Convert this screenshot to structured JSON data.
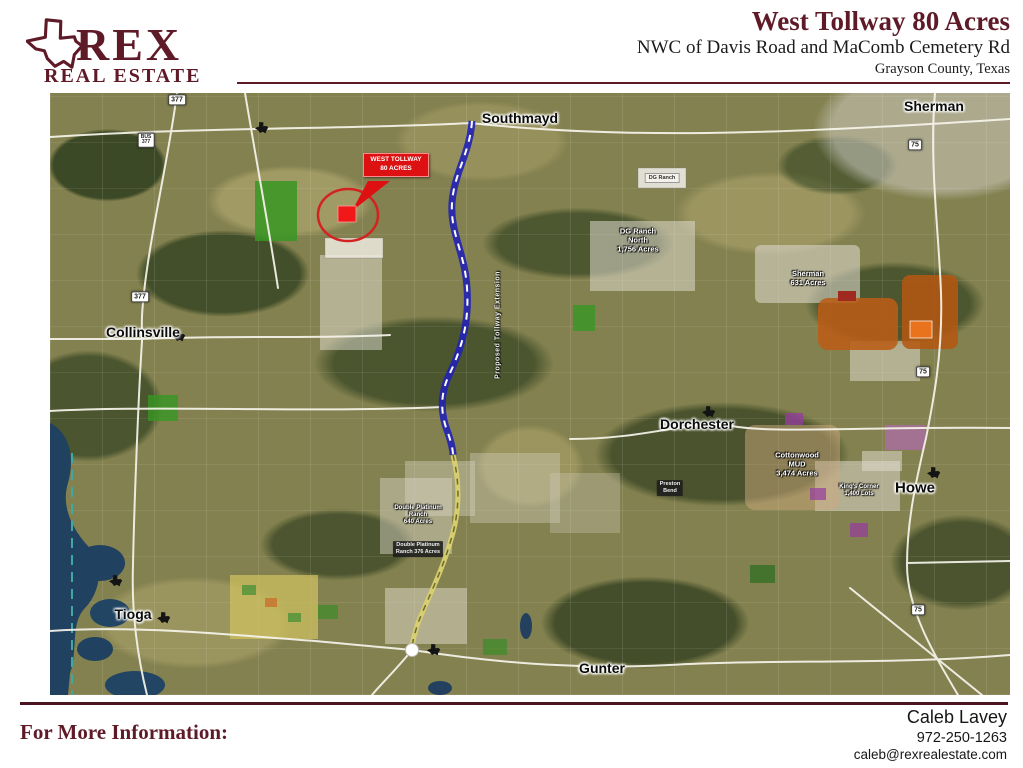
{
  "header": {
    "brand_name": "REX",
    "brand_subtitle": "REAL ESTATE",
    "title": "West Tollway 80 Acres",
    "subtitle": "NWC of Davis Road and MaComb Cemetery Rd",
    "location": "Grayson County, Texas"
  },
  "map": {
    "callout": {
      "line1": "WEST TOLLWAY",
      "line2": "80 ACRES"
    },
    "route_label": "Proposed Tollway Extension",
    "cities": [
      {
        "label": "Southmayd"
      },
      {
        "label": "Sherman"
      },
      {
        "label": "Collinsville"
      },
      {
        "label": "Dorchester"
      },
      {
        "label": "Howe"
      },
      {
        "label": "Tioga"
      },
      {
        "label": "Gunter"
      }
    ],
    "parcels": [
      {
        "label": "DG Ranch\nNorth\n1,756 Acres"
      },
      {
        "label": "Sherman\n631 Acres"
      },
      {
        "label": "Cottonwood\nMUD\n3,474 Acres"
      },
      {
        "label": "King's Corner\n1,400 Lots"
      },
      {
        "label": "Double Platinum\nRanch\n640 Acres"
      },
      {
        "label": "DG Ranch"
      },
      {
        "label": "Double Platinum\nRanch 376 Acres"
      },
      {
        "label": "Preston\nBend"
      }
    ],
    "shields": [
      {
        "label": "377"
      },
      {
        "label": "BUS\n377"
      },
      {
        "label": "377"
      },
      {
        "label": "75"
      },
      {
        "label": "75"
      },
      {
        "label": "75"
      }
    ],
    "colors": {
      "maroon": "#5f1a28",
      "callout_red": "#dd1111",
      "route_blue": "#2222b4",
      "route_yellow": "#d9d070",
      "water": "#20415f"
    }
  },
  "footer": {
    "info_label": "For More Information:",
    "contact_name": "Caleb Lavey",
    "contact_phone": "972-250-1263",
    "contact_email": "caleb@rexrealestate.com"
  }
}
